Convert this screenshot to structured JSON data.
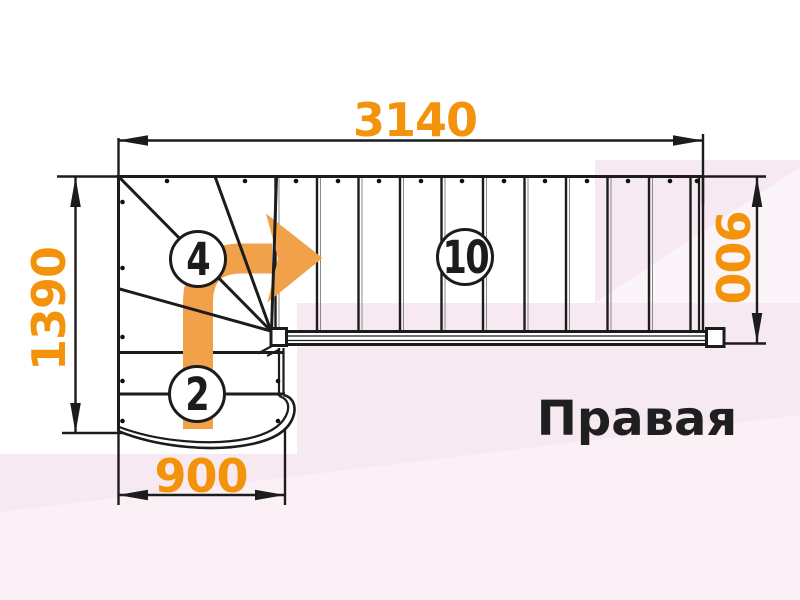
{
  "diagram": {
    "title": "Правая",
    "dimensions": {
      "top": "3140",
      "left": "1390",
      "right": "900",
      "bottom": "900"
    },
    "step_counts": {
      "lower_flight": "2",
      "winders": "4",
      "upper_flight": "10"
    }
  },
  "colors": {
    "line_black": "#1c1c1c",
    "dimension_orange": "#f2930b",
    "arrow_orange": "#f0a149",
    "background_pink": "#f7e9f2"
  }
}
